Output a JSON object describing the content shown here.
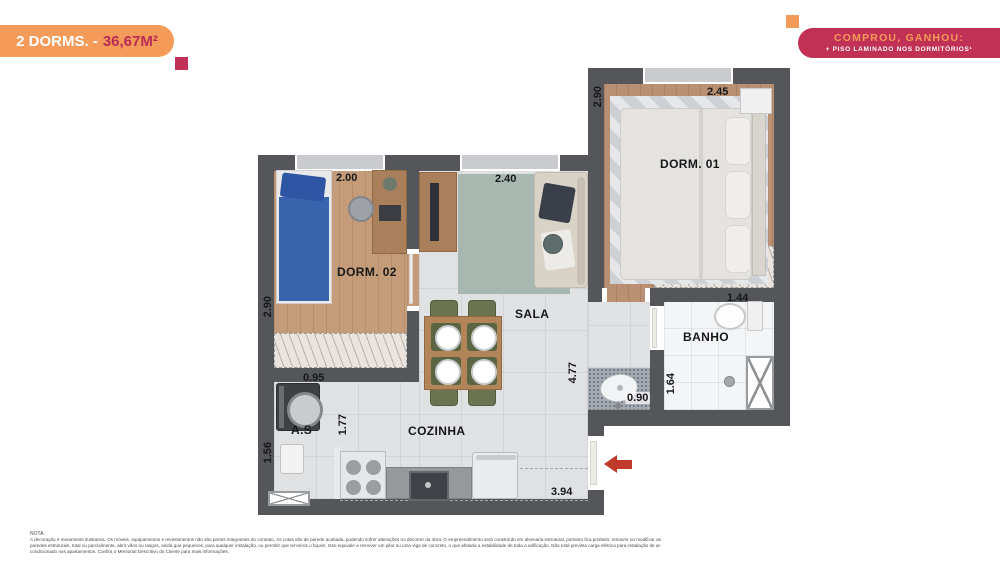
{
  "header": {
    "badge": {
      "label": "2 DORMS. -",
      "area": "36,67M²"
    },
    "promo": {
      "title": "COMPROU, GANHOU:",
      "subtitle": "+ PISO LAMINADO NOS DORMITÓRIOS¹"
    }
  },
  "colors": {
    "orange": "#F49B59",
    "magenta": "#C13055",
    "wall_gray": "#55565A",
    "arrow_red": "#C0392B",
    "wood_floor": "#C59C79",
    "sala_rug": "#A9B7B1"
  },
  "rooms": {
    "dorm01": {
      "label": "DORM. 01",
      "width": "2.45",
      "height": "2.90"
    },
    "dorm02": {
      "label": "DORM. 02",
      "width": "2.00",
      "height": "2.90"
    },
    "sala": {
      "label": "SALA",
      "width": "2.40",
      "height": "4.77"
    },
    "banho": {
      "label": "BANHO",
      "width": "1.44",
      "height": "1.64"
    },
    "lavabo": {
      "width": "0.90"
    },
    "as": {
      "label": "A.S",
      "width": "0.95",
      "height": "1.56"
    },
    "cozinha": {
      "label": "COZINHA",
      "depth": "1.77",
      "width": "3.94"
    }
  },
  "note": {
    "title": "NOTA.",
    "body": "A decoração é meramente ilustrativa. Os móveis, equipamentos e revestimentos não são partes integrantes do contrato. As cotas são de parede acabada, podendo sofrer alterações no decorrer da obra. O empreendimento será construído em alvenaria estrutural, portanto fica proibido: remover ou modificar as paredes estruturais, total ou parcialmente, abrir vãos ou rasgos, ainda que pequenos, para qualquer instalação, ou permitir que terceiros o façam. Isso equivale a remover um pilar ou uma viga de concreto, o que afetaria a estabilidade de toda a edificação. Não está prevista carga elétrica para instalação de ar-condicionado nos apartamentos. Confira o Memorial Descritivo do Cliente para mais informações."
  }
}
